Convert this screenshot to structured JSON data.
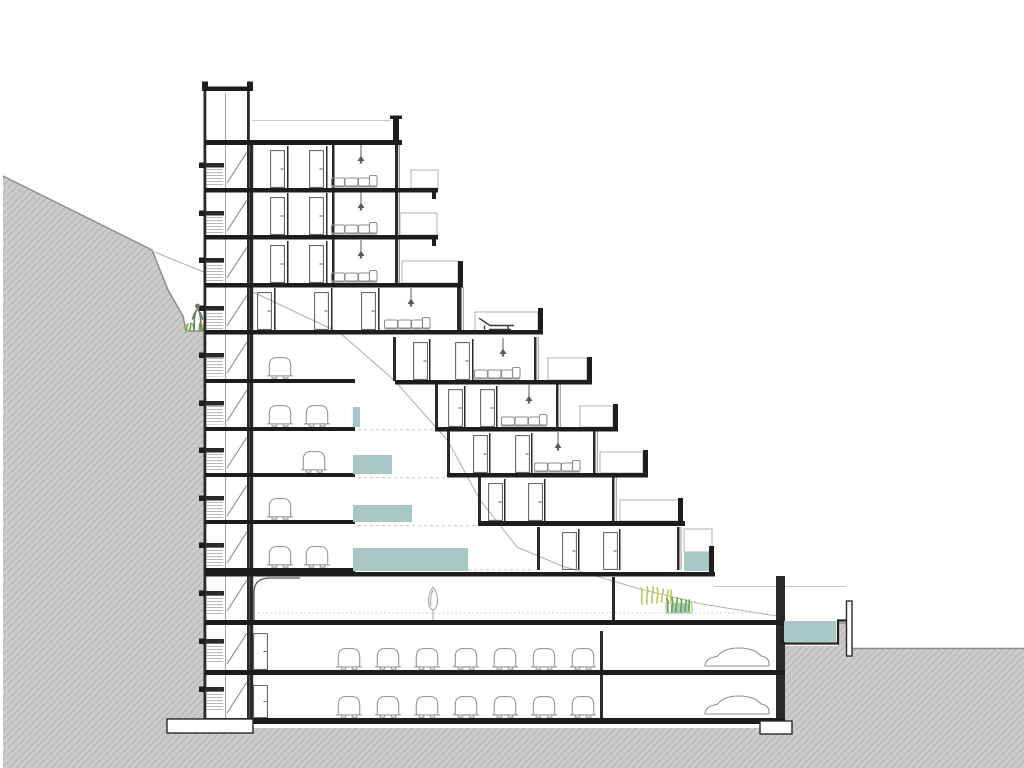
{
  "palette": {
    "bg": "#ffffff",
    "ink": "#1d1d1d",
    "wall": "#2a2a2a",
    "mid": "#5a5a5a",
    "furniture": "#8f8f8f",
    "light-line": "#b0b0b0",
    "faint": "#c6c6c6",
    "terrain": "#cbcbcb",
    "terrain-hatch": "#b6b6b6",
    "terrain-edge": "#8d8d8d",
    "water": "#a8c7c5",
    "plant-green": "#62a845",
    "plant-yellow": "#b9ca55",
    "figure": "#6e7b66",
    "ground-trace": "#b8b4a8"
  },
  "scene": {
    "type": "architectural-cross-section",
    "site": "hillside sloping down from upper left to lower right",
    "levels": {
      "terraced_residential_floors": 9,
      "garden_driveway_level": 1,
      "basement_parking_levels": 2,
      "mezzanine_parking_tiers": 5
    },
    "elements": {
      "doors": 21,
      "sofas": 7,
      "pendant_lamps": 7,
      "cars_front_view": 21,
      "cars_profile_view": 2,
      "sun_loungers": 1,
      "terrace_pools": 6,
      "outdoor_pool_basin": 1,
      "planters": 2,
      "trees": 1,
      "people": 1,
      "stair_core_flights": 12
    }
  }
}
